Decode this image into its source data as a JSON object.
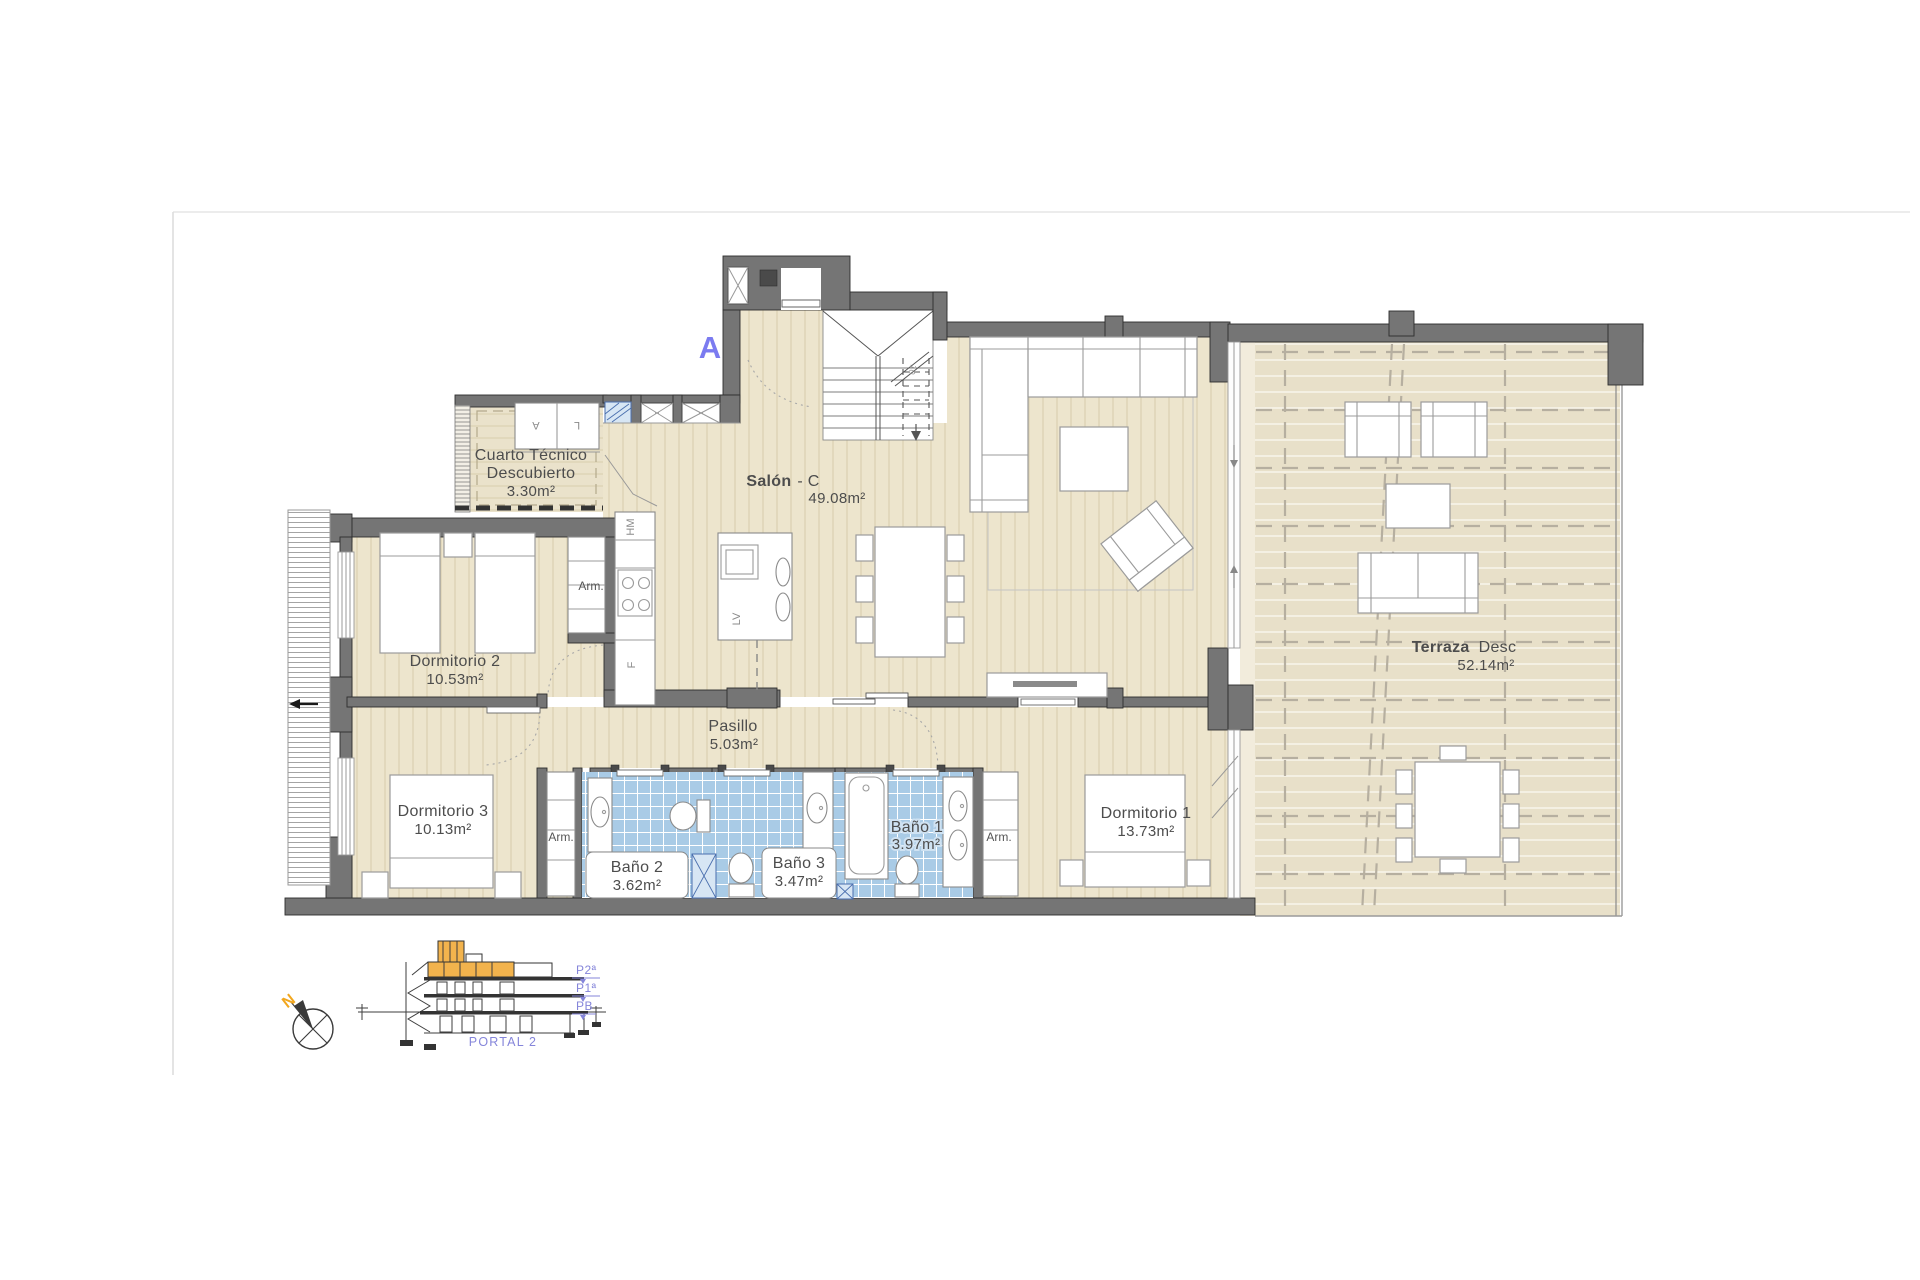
{
  "plan": {
    "section_marker": "A",
    "rooms": {
      "cuarto_tecnico": {
        "line1": "Cuarto Técnico",
        "line2": "Descubierto",
        "area": "3.30m²"
      },
      "salon": {
        "name": "Salón",
        "suffix": "- C",
        "area": "49.08m²"
      },
      "dormitorio_2": {
        "name": "Dormitorio 2",
        "area": "10.53m²"
      },
      "dormitorio_3": {
        "name": "Dormitorio 3",
        "area": "10.13m²"
      },
      "dormitorio_1": {
        "name": "Dormitorio 1",
        "area": "13.73m²"
      },
      "pasillo": {
        "name": "Pasillo",
        "area": "5.03m²"
      },
      "bano_1": {
        "name": "Baño 1",
        "area": "3.97m²"
      },
      "bano_2": {
        "name": "Baño 2",
        "area": "3.62m²"
      },
      "bano_3": {
        "name": "Baño 3",
        "area": "3.47m²"
      },
      "terraza": {
        "name": "Terraza",
        "name2": "Desc",
        "area": "52.14m²"
      }
    },
    "labels": {
      "closet": "Arm.",
      "hm": "HM",
      "fridge": "F",
      "dishwasher": "LV",
      "washer": "A",
      "dryer": "L",
      "stair_steps": "10"
    }
  },
  "legend": {
    "compass_north": "N",
    "section": {
      "floor_2": "P2ª",
      "floor_1": "P1ª",
      "ground": "PB",
      "portal": "PORTAL 2"
    }
  },
  "colors": {
    "accent_blue": "#7b7bf0",
    "floor_beige": "#ede5cd",
    "terrace_beige": "#e8e0c9",
    "tile_blue": "#a9cbe6",
    "wall_gray": "#757575",
    "highlight_orange": "#f2b34d"
  }
}
